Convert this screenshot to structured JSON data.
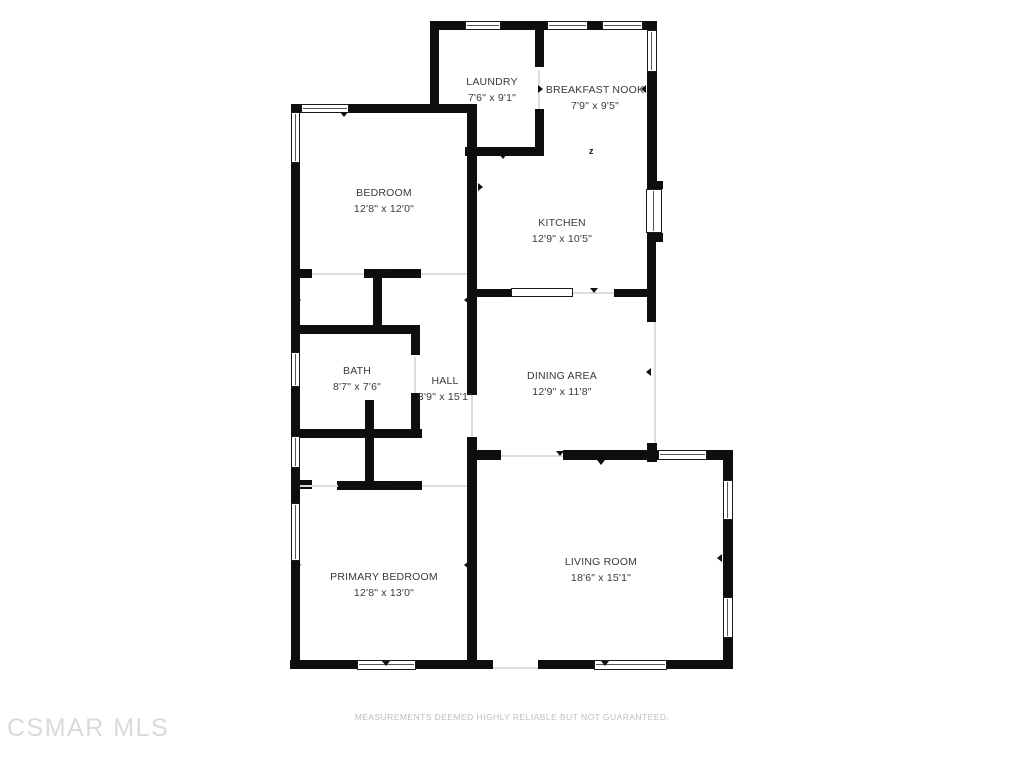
{
  "rooms": [
    {
      "id": "laundry",
      "name": "LAUNDRY",
      "dims": "7'6\" x 9'1\""
    },
    {
      "id": "breakfast-nook",
      "name": "BREAKFAST NOOK",
      "dims": "7'9\" x 9'5\""
    },
    {
      "id": "bedroom",
      "name": "BEDROOM",
      "dims": "12'8\" x 12'0\""
    },
    {
      "id": "kitchen",
      "name": "KITCHEN",
      "dims": "12'9\" x 10'5\""
    },
    {
      "id": "bath",
      "name": "BATH",
      "dims": "8'7\" x 7'6\""
    },
    {
      "id": "hall",
      "name": "HALL",
      "dims": "3'9\" x 15'1\""
    },
    {
      "id": "dining-area",
      "name": "DINING AREA",
      "dims": "12'9\" x 11'8\""
    },
    {
      "id": "primary-bedroom",
      "name": "PRIMARY BEDROOM",
      "dims": "12'8\" x 13'0\""
    },
    {
      "id": "living-room",
      "name": "LIVING ROOM",
      "dims": "18'6\" x 15'1\""
    }
  ],
  "footer": {
    "disclaimer": "MEASUREMENTS DEEMED HIGHLY RELIABLE BUT NOT GUARANTEED."
  },
  "watermark": {
    "text": "CSMAR MLS"
  },
  "symbols": {
    "north_marker": "z"
  },
  "colors": {
    "wall": "#0e0e0e",
    "label_text": "#3a3a3a",
    "disclaimer_text": "#bdbdbd",
    "watermark_text": "#dadada",
    "opening_line": "#dcdcdc",
    "window_fill": "#ffffff"
  }
}
